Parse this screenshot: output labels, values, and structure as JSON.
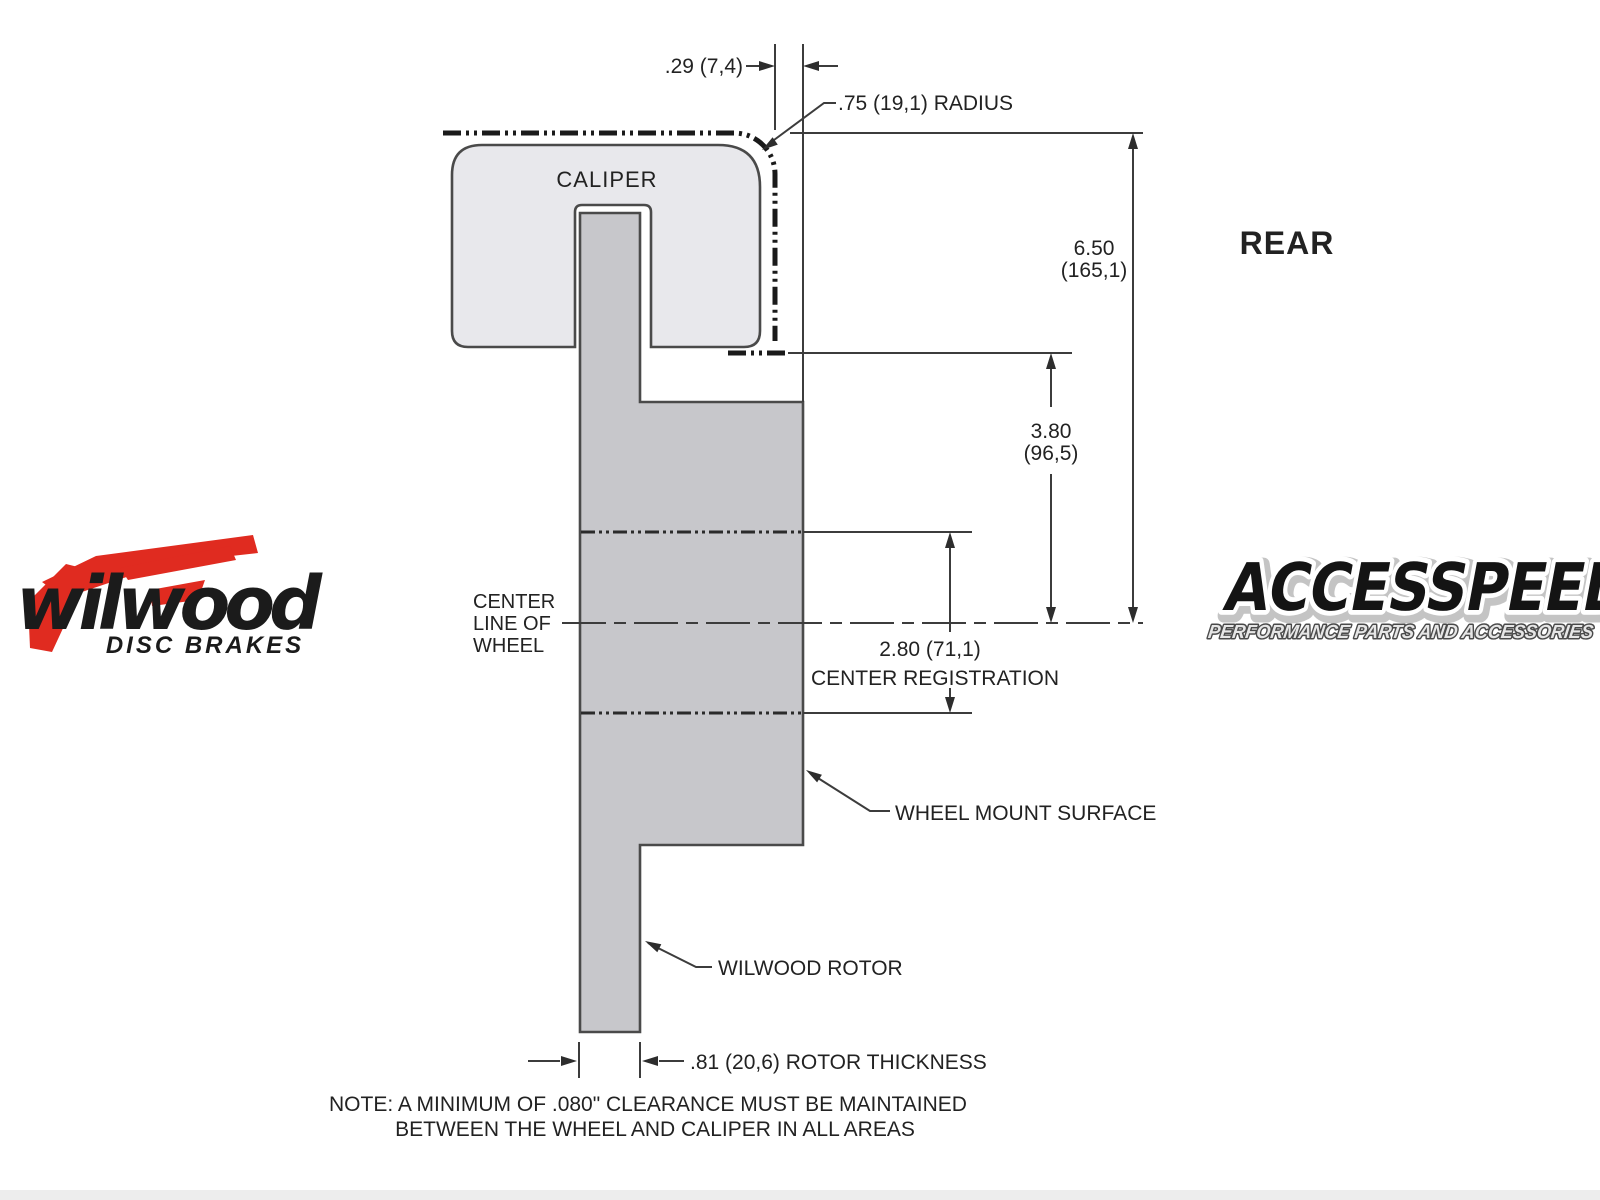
{
  "drawing": {
    "caliper_label": "CALIPER",
    "view_label": "REAR",
    "dimensions": {
      "caliper_offset": ".29 (7,4)",
      "radius": ".75 (19,1) RADIUS",
      "overall_height": [
        "6.50",
        "(165,1)"
      ],
      "caliper_clearance_height": [
        "3.80",
        "(96,5)"
      ],
      "center_registration": [
        "2.80 (71,1)",
        "CENTER REGISTRATION"
      ],
      "rotor_thickness": ".81 (20,6) ROTOR THICKNESS"
    },
    "labels": {
      "center_line": [
        "CENTER",
        "LINE OF",
        "WHEEL"
      ],
      "wheel_mount_surface": "WHEEL MOUNT SURFACE",
      "wilwood_rotor": "WILWOOD ROTOR"
    },
    "note": [
      "NOTE: A MINIMUM OF .080\" CLEARANCE MUST BE MAINTAINED",
      "BETWEEN THE WHEEL AND CALIPER IN ALL AREAS"
    ]
  },
  "logos": {
    "wilwood": {
      "name": "wilwood",
      "tagline": "DISC BRAKES"
    },
    "accesspeed": {
      "name": "ACCESSPEED",
      "tagline": "PERFORMANCE PARTS AND ACCESSORIES"
    }
  },
  "colors": {
    "caliper_fill": "#e8e8ec",
    "rotor_fill": "#c7c7cb",
    "shape_outline": "#4a4a4a",
    "dimension_line": "#3c3c3c",
    "text": "#222222",
    "wilwood_red": "#e02b20",
    "logo_black": "#1b1b1b",
    "accesspeed_fill": "#141414"
  }
}
